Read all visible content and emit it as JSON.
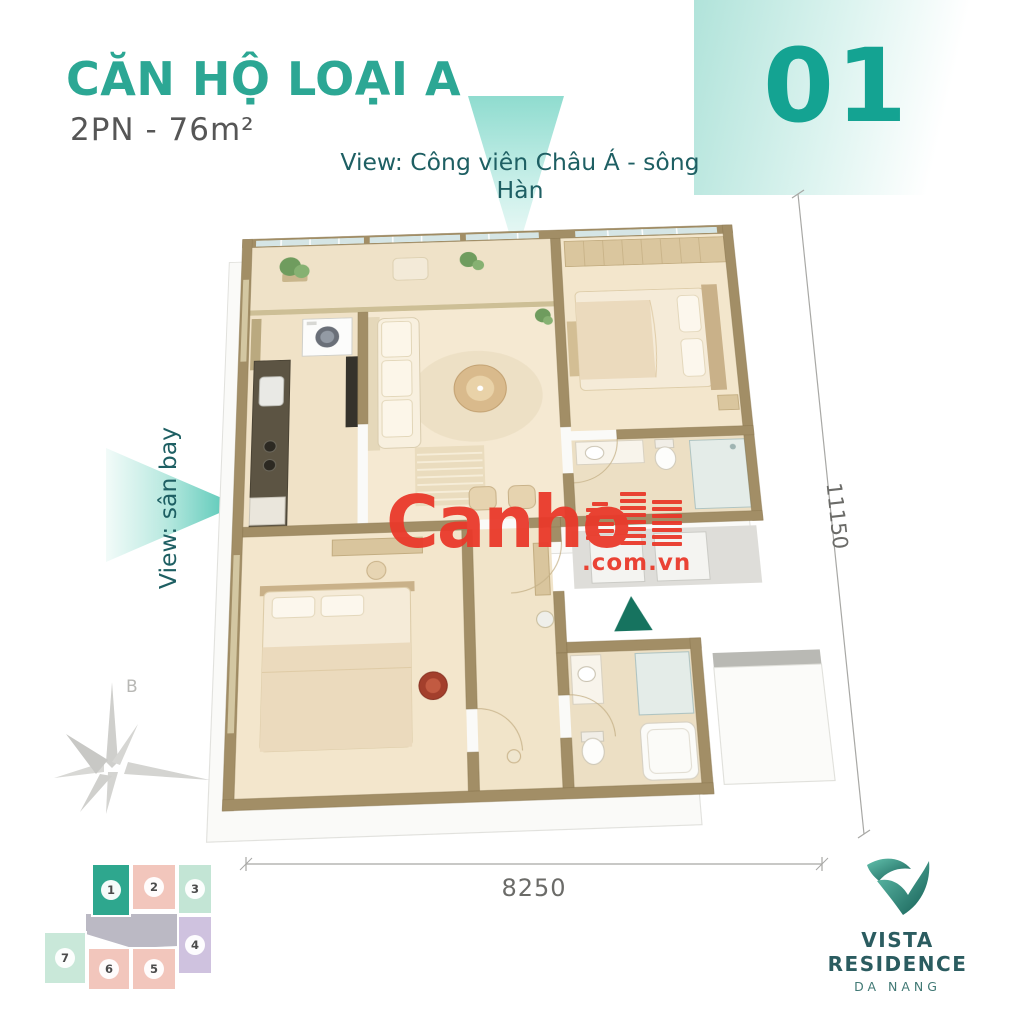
{
  "header": {
    "title": "CĂN HỘ LOẠI A",
    "subtitle": "2PN - 76m²",
    "unit_number": "01",
    "accent_color": "#2CA794"
  },
  "views": {
    "top_label": "View: Công viên Châu Á - sông Hàn",
    "left_label": "View: sân bay"
  },
  "floor_plan": {
    "dimension_vertical": "11150",
    "dimension_horizontal": "8250",
    "entry_marker_color": "#16735F",
    "wall_color": "#A28E66",
    "floor_color": "#F3E7D1"
  },
  "compass": {
    "north_label": "B"
  },
  "watermark": {
    "name": "Canho",
    "suffix": ".com.vn",
    "color": "#E9392B"
  },
  "key_plan": {
    "highlighted_unit": "1",
    "corridor_color": "#BBB9C4",
    "units": [
      {
        "number": "1",
        "color": "#2EA78E"
      },
      {
        "number": "2",
        "color": "#F2C6BC"
      },
      {
        "number": "3",
        "color": "#C3E5D5"
      },
      {
        "number": "4",
        "color": "#CFC2DF"
      },
      {
        "number": "5",
        "color": "#F2C6BC"
      },
      {
        "number": "6",
        "color": "#F2C6BC"
      },
      {
        "number": "7",
        "color": "#C9E8D9"
      }
    ]
  },
  "brand": {
    "name": "VISTA RESIDENCE",
    "location": "DA NANG"
  }
}
